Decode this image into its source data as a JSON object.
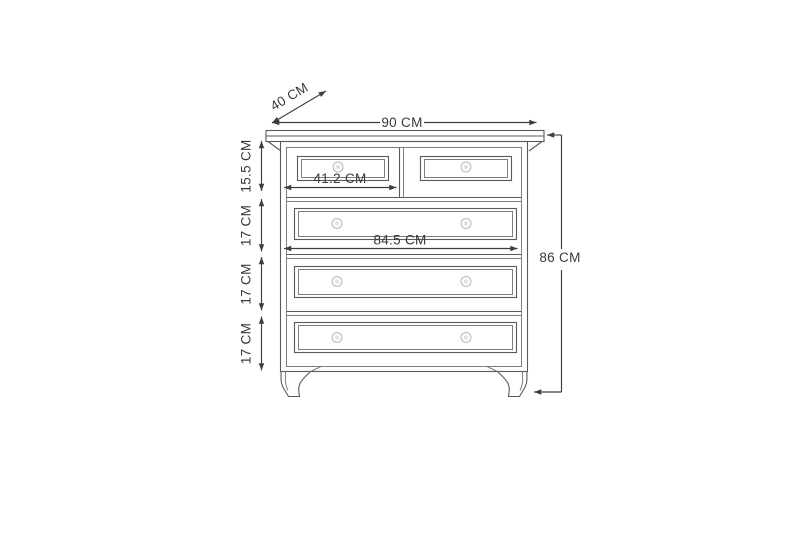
{
  "diagram": {
    "subject": "chest of drawers"
  },
  "dimensions": {
    "depth": "40 CM",
    "width": "90 CM",
    "height": "86 CM",
    "top_drawer_row_height": "15.5 CM",
    "second_row_height": "17 CM",
    "third_row_height": "17 CM",
    "fourth_row_height": "17 CM",
    "small_drawer_width": "41.2 CM",
    "large_drawer_width": "84.5 CM"
  },
  "colors": {
    "furniture_line": "#595a5e",
    "panel_line": "#7d7e82",
    "dimension_line": "#3e3e40",
    "text": "#39393b",
    "knob": "#bcbcbe",
    "background": "#ffffff"
  }
}
